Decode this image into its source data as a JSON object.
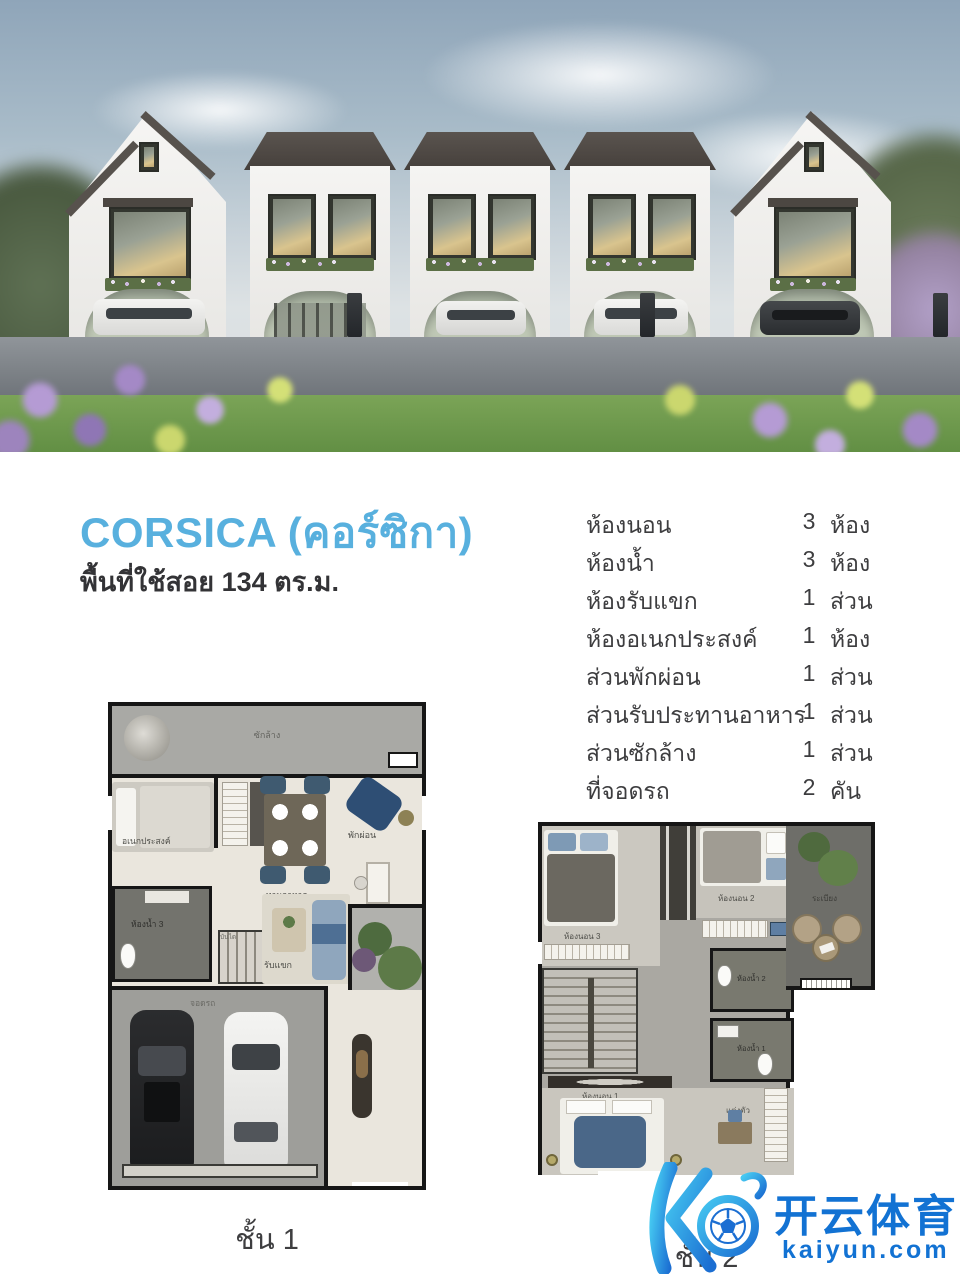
{
  "title": {
    "name": "CORSICA (คอร์ซิกา)",
    "area_label": "พื้นที่ใช้สอย 134 ตร.ม."
  },
  "specs": {
    "rows": [
      {
        "label": "ห้องนอน",
        "num": "3",
        "unit": "ห้อง"
      },
      {
        "label": "ห้องน้ำ",
        "num": "3",
        "unit": "ห้อง"
      },
      {
        "label": "ห้องรับแขก",
        "num": "1",
        "unit": "ส่วน"
      },
      {
        "label": "ห้องอเนกประสงค์",
        "num": "1",
        "unit": "ห้อง"
      },
      {
        "label": "ส่วนพักผ่อน",
        "num": "1",
        "unit": "ส่วน"
      },
      {
        "label": "ส่วนรับประทานอาหาร",
        "num": "1",
        "unit": "ส่วน"
      },
      {
        "label": "ส่วนซักล้าง",
        "num": "1",
        "unit": "ส่วน"
      },
      {
        "label": "ที่จอดรถ",
        "num": "2",
        "unit": "คัน"
      }
    ]
  },
  "floor1": {
    "caption": "ชั้น 1",
    "labels": {
      "laundry": "ซักล้าง",
      "multipurpose": "อเนกประสงค์",
      "dining": "ทานอาหาร",
      "relax": "พักผ่อน",
      "bath3": "ห้องน้ำ 3",
      "stairs": "บันได",
      "living": "รับแขก",
      "parking": "จอดรถ"
    }
  },
  "floor2": {
    "caption": "ชั้น 2",
    "labels": {
      "bedroom3": "ห้องนอน 3",
      "bedroom2": "ห้องนอน 2",
      "balcony": "ระเบียง",
      "bath2": "ห้องน้ำ 2",
      "bath1": "ห้องน้ำ 1",
      "bedroom1": "ห้องนอน 1",
      "dressing": "แต่งตัว"
    }
  },
  "watermark": {
    "brand": "开云体育",
    "domain": "kaiyun.com"
  },
  "colors": {
    "title_blue": "#58b0de",
    "text_dark": "#3d3d3f",
    "watermark_blue": "#1272d3"
  }
}
